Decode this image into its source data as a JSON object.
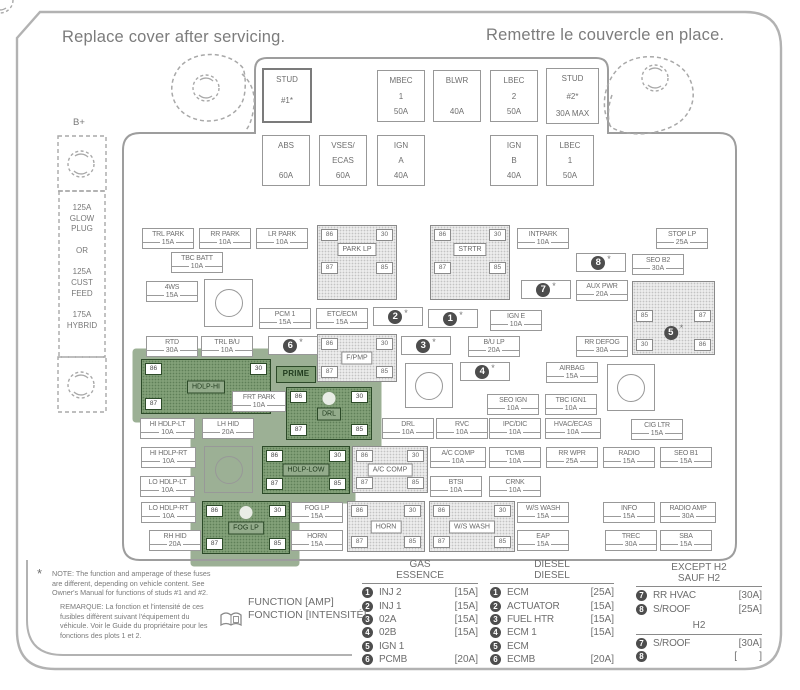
{
  "header": {
    "title_en": "Replace cover after servicing.",
    "title_fr": "Remettre le couvercle en place."
  },
  "battery": {
    "label": "B+",
    "cable_lines": [
      "125A",
      "GLOW",
      "PLUG",
      "OR",
      "125A",
      "CUST",
      "FEED",
      "175A",
      "HYBRID"
    ]
  },
  "misc": {
    "star": "*"
  },
  "maxi_fuses": [
    {
      "lines": [
        "STUD",
        "#1*",
        ""
      ]
    },
    {
      "lines": [
        "MBEC",
        "1",
        "50A"
      ]
    },
    {
      "lines": [
        "BLWR",
        "",
        "40A"
      ]
    },
    {
      "lines": [
        "LBEC",
        "2",
        "50A"
      ]
    },
    {
      "lines": [
        "STUD",
        "#2*",
        "30A MAX"
      ]
    },
    {
      "lines": [
        "ABS",
        "",
        "60A"
      ]
    },
    {
      "lines": [
        "VSES/",
        "ECAS",
        "60A"
      ]
    },
    {
      "lines": [
        "IGN",
        "A",
        "40A"
      ]
    },
    {
      "lines": [
        "IGN",
        "B",
        "40A"
      ]
    },
    {
      "lines": [
        "LBEC",
        "1",
        "50A"
      ]
    }
  ],
  "fuses": [
    {
      "label": "TRL PARK",
      "amp": "15A"
    },
    {
      "label": "RR PARK",
      "amp": "10A"
    },
    {
      "label": "LR PARK",
      "amp": "10A"
    },
    {
      "label": "INTPARK",
      "amp": "10A"
    },
    {
      "label": "STOP LP",
      "amp": "25A"
    },
    {
      "label": "TBC BATT",
      "amp": "10A"
    },
    {
      "label": "SEO B2",
      "amp": "30A"
    },
    {
      "label": "4WS",
      "amp": "15A"
    },
    {
      "label": "AUX PWR",
      "amp": "20A"
    },
    {
      "label": "PCM 1",
      "amp": "15A"
    },
    {
      "label": "ETC/ECM",
      "amp": "15A"
    },
    {
      "label": "IGN E",
      "amp": "10A"
    },
    {
      "label": "RTD",
      "amp": "30A"
    },
    {
      "label": "TRL B/U",
      "amp": "10A"
    },
    {
      "label": "B/U LP",
      "amp": "20A"
    },
    {
      "label": "RR DEFOG",
      "amp": "30A"
    },
    {
      "label": "AIRBAG",
      "amp": "15A"
    },
    {
      "label": "FRT PARK",
      "amp": "10A"
    },
    {
      "label": "SEO IGN",
      "amp": "10A"
    },
    {
      "label": "TBC IGN1",
      "amp": "10A"
    },
    {
      "label": "HI HDLP-LT",
      "amp": "10A"
    },
    {
      "label": "LH HID",
      "amp": "20A"
    },
    {
      "label": "DRL",
      "amp": "10A"
    },
    {
      "label": "RVC",
      "amp": "10A"
    },
    {
      "label": "IPC/DIC",
      "amp": "10A"
    },
    {
      "label": "HVAC/ECAS",
      "amp": "10A"
    },
    {
      "label": "CIG LTR",
      "amp": "15A"
    },
    {
      "label": "HI HDLP-RT",
      "amp": "10A"
    },
    {
      "label": "A/C COMP",
      "amp": "10A"
    },
    {
      "label": "TCMB",
      "amp": "10A"
    },
    {
      "label": "RR WPR",
      "amp": "25A"
    },
    {
      "label": "RADIO",
      "amp": "15A"
    },
    {
      "label": "SEO B1",
      "amp": "15A"
    },
    {
      "label": "LO HDLP-LT",
      "amp": "10A"
    },
    {
      "label": "BTSI",
      "amp": "10A"
    },
    {
      "label": "CRNK",
      "amp": "10A"
    },
    {
      "label": "LO HDLP-RT",
      "amp": "10A"
    },
    {
      "label": "FOG LP",
      "amp": "15A"
    },
    {
      "label": "W/S WASH",
      "amp": "15A"
    },
    {
      "label": "INFO",
      "amp": "15A"
    },
    {
      "label": "RADIO AMP",
      "amp": "30A"
    },
    {
      "label": "RH HID",
      "amp": "20A"
    },
    {
      "label": "HORN",
      "amp": "15A"
    },
    {
      "label": "EAP",
      "amp": "15A"
    },
    {
      "label": "TREC",
      "amp": "30A"
    },
    {
      "label": "SBA",
      "amp": "15A"
    }
  ],
  "badge_fuses": [
    {
      "num": "8"
    },
    {
      "num": "7"
    },
    {
      "num": "2"
    },
    {
      "num": "1"
    },
    {
      "num": "6"
    },
    {
      "num": "3"
    },
    {
      "num": "4"
    }
  ],
  "relays": [
    {
      "name": "PARK LP",
      "pins": [
        "86",
        "30",
        "87",
        "85"
      ]
    },
    {
      "name": "STRTR",
      "pins": [
        "86",
        "30",
        "87",
        "85"
      ]
    },
    {
      "name": "F/PMP",
      "pins": [
        "86",
        "30",
        "87",
        "85"
      ]
    },
    {
      "name": "HDLP-HI",
      "pins": [
        "86",
        "30",
        "87",
        "85"
      ]
    },
    {
      "name": "DRL",
      "pins": [
        "86",
        "30",
        "87",
        "85"
      ]
    },
    {
      "name": "HDLP-LOW",
      "pins": [
        "86",
        "30",
        "87",
        "85"
      ]
    },
    {
      "name": "FOG LP",
      "pins": [
        "86",
        "30",
        "87",
        "85"
      ]
    },
    {
      "name": "A/C COMP",
      "pins": [
        "86",
        "30",
        "87",
        "85"
      ]
    },
    {
      "name": "HORN",
      "pins": [
        "86",
        "30",
        "87",
        "85"
      ]
    },
    {
      "name": "W/S WASH",
      "pins": [
        "86",
        "30",
        "87",
        "85"
      ]
    }
  ],
  "relay5": {
    "num": "5",
    "pins": [
      "85",
      "87",
      "30",
      "86"
    ]
  },
  "prime_label": "PRIME",
  "legend": {
    "function_en": "FUNCTION [AMP]",
    "function_fr": "FONCTION [INTENSITÉ]",
    "gas": {
      "header1": "GAS",
      "header2": "ESSENCE",
      "rows": [
        {
          "num": "1",
          "name": "INJ 2",
          "amp": "[15A]"
        },
        {
          "num": "2",
          "name": "INJ 1",
          "amp": "[15A]"
        },
        {
          "num": "3",
          "name": "02A",
          "amp": "[15A]"
        },
        {
          "num": "4",
          "name": "02B",
          "amp": "[15A]"
        },
        {
          "num": "5",
          "name": "IGN 1",
          "amp": ""
        },
        {
          "num": "6",
          "name": "PCMB",
          "amp": "[20A]"
        }
      ]
    },
    "diesel": {
      "header1": "DIESEL",
      "header2": "DIESEL",
      "rows": [
        {
          "num": "1",
          "name": "ECM",
          "amp": "[25A]"
        },
        {
          "num": "2",
          "name": "ACTUATOR",
          "amp": "[15A]"
        },
        {
          "num": "3",
          "name": "FUEL HTR",
          "amp": "[15A]"
        },
        {
          "num": "4",
          "name": "ECM 1",
          "amp": "[15A]"
        },
        {
          "num": "5",
          "name": "ECM",
          "amp": ""
        },
        {
          "num": "6",
          "name": "ECMB",
          "amp": "[20A]"
        }
      ]
    },
    "except_h2": {
      "header1": "EXCEPT H2",
      "header2": "SAUF H2",
      "rows": [
        {
          "num": "7",
          "name": "RR HVAC",
          "amp": "[30A]"
        },
        {
          "num": "8",
          "name": "S/ROOF",
          "amp": "[25A]"
        }
      ]
    },
    "h2": {
      "header": "H2",
      "rows": [
        {
          "num": "7",
          "name": "S/ROOF",
          "amp": "[30A]"
        },
        {
          "num": "8",
          "name": "",
          "amp": "[        ]"
        }
      ]
    }
  },
  "notes": {
    "marker": "*",
    "note_en": "NOTE:  The function and amperage of these fuses are different, depending on vehicle content. See Owner's Manual for functions of studs #1 and #2.",
    "note_fr": "REMARQUE:  La fonction et l'intensité de ces fusibles diffèrent suivant l'équipement du véhicule. Voir le Guide du propriétaire pour les fonctions des plots 1 et 2."
  }
}
